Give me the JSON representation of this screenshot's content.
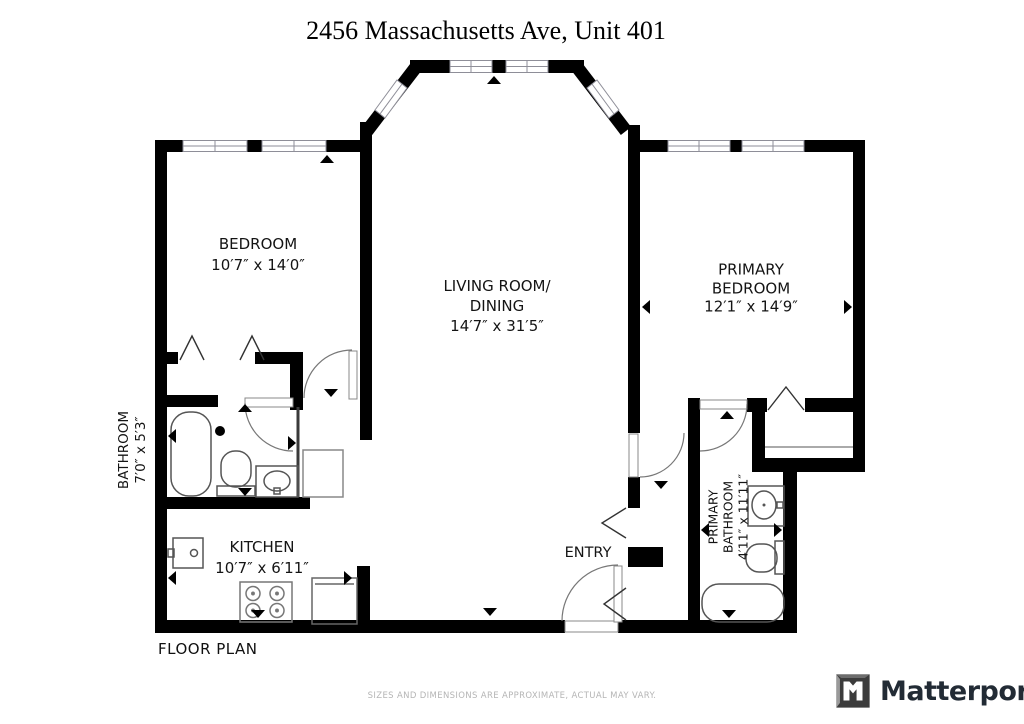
{
  "title": "2456 Massachusetts Ave, Unit 401",
  "labels": {
    "bedroom": {
      "line1": "BEDROOM",
      "line2": "10′7″ x 14′0″"
    },
    "living": {
      "line1": "LIVING ROOM/",
      "line2": "DINING",
      "line3": "14′7″ x 31′5″"
    },
    "primary_bedroom": {
      "line1": "PRIMARY",
      "line2": "BEDROOM",
      "line3": "12′1″ x 14′9″"
    },
    "bathroom": {
      "line1": "BATHROOM",
      "line2": "7′0″ x 5′3″"
    },
    "kitchen": {
      "line1": "KITCHEN",
      "line2": "10′7″ x 6′11″"
    },
    "primary_bathroom": {
      "line1": "PRIMARY",
      "line2": "BATHROOM",
      "line3": "4′11″ x 11′11″"
    },
    "entry": {
      "line1": "ENTRY"
    }
  },
  "footer": {
    "plan_label": "FLOOR PLAN",
    "disclaimer": "SIZES AND DIMENSIONS ARE APPROXIMATE, ACTUAL MAY VARY.",
    "brand": "Matterport"
  },
  "colors": {
    "wall": "#000000",
    "fixture_stroke": "#555555",
    "window_stroke": "#8e8e98",
    "label_text": "#141414",
    "disclaimer_text": "#b5b5b5",
    "brand_text": "#222b35"
  }
}
